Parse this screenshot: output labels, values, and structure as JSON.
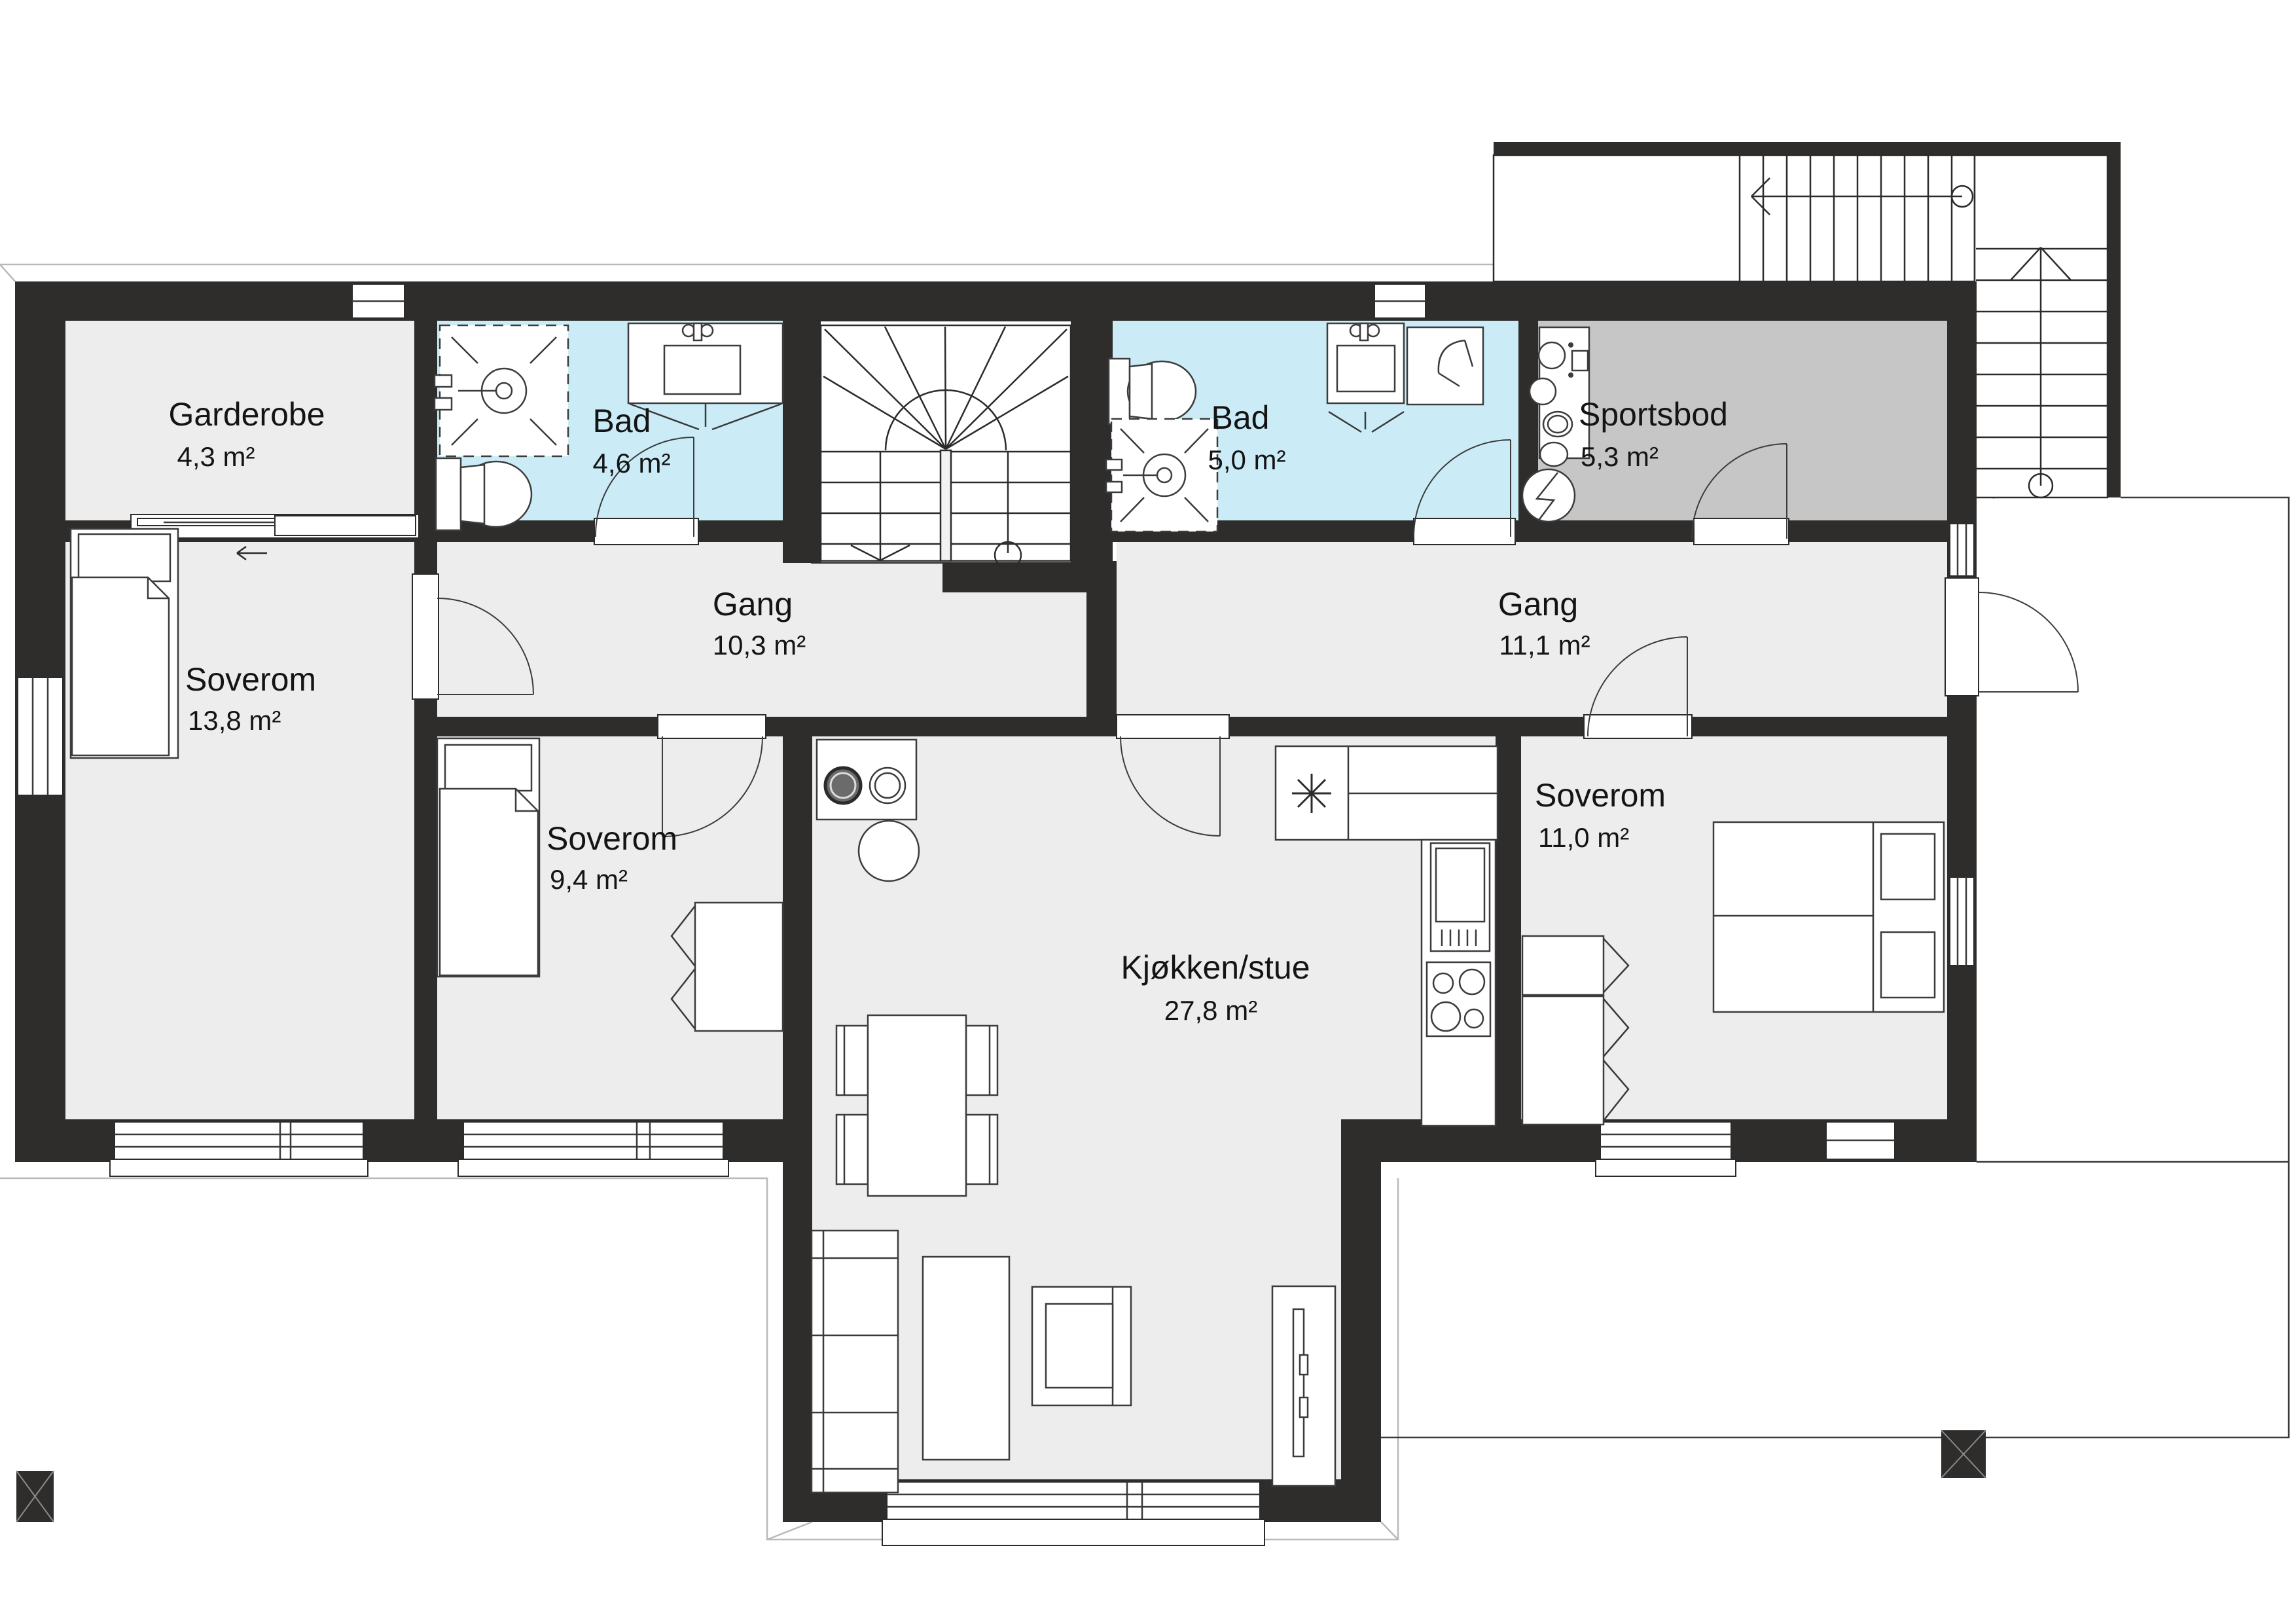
{
  "colors": {
    "wall": "#2e2d2c",
    "floor": "#ededed",
    "bathroom": "#cbecf7",
    "storage": "#c6c6c6",
    "stair": "#ffffff",
    "line": "#3a3a3a"
  },
  "rooms": [
    {
      "name": "Garderobe",
      "area": "4,3 m²"
    },
    {
      "name": "Bad",
      "area": "4,6 m²"
    },
    {
      "name": "Bad",
      "area": "5,0 m²"
    },
    {
      "name": "Sportsbod",
      "area": "5,3 m²"
    },
    {
      "name": "Gang",
      "area": "10,3 m²"
    },
    {
      "name": "Gang",
      "area": "11,1 m²"
    },
    {
      "name": "Soverom",
      "area": "13,8 m²"
    },
    {
      "name": "Soverom",
      "area": "9,4 m²"
    },
    {
      "name": "Soverom",
      "area": "11,0 m²"
    },
    {
      "name": "Kjøkken/stue",
      "area": "27,8 m²"
    }
  ]
}
